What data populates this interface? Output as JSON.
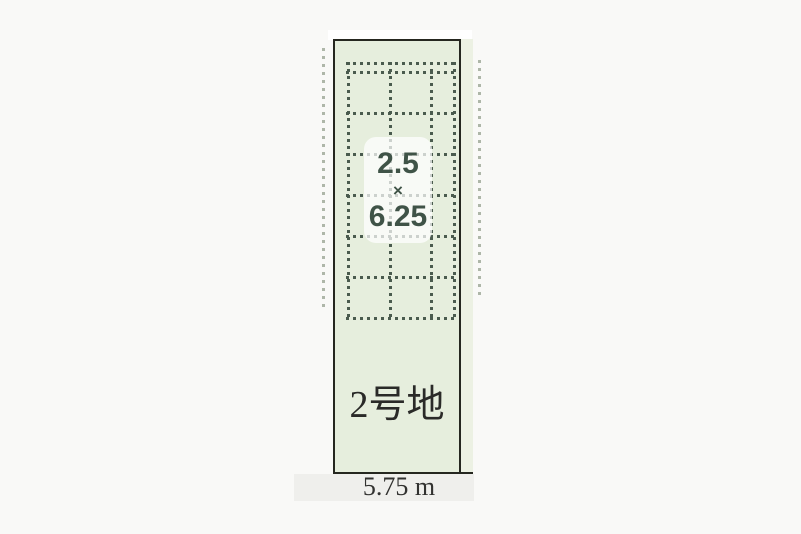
{
  "diagram": {
    "plot_name": "2号地",
    "size_label": {
      "width": "2.5",
      "times": "×",
      "depth": "6.25"
    },
    "frontage": "5.75 m"
  },
  "colors": {
    "page_bg": "#f9f9f7",
    "top_strip_bg": "#ffffff",
    "bottom_strip_bg": "#efefec",
    "plot_fill": "#e6eedd",
    "plot_fill_light": "#ecf1e3",
    "plot_border": "#25271f",
    "grid_dot": "#4a5b4e",
    "grid_dot_faded": "#9ba695",
    "size_text": "#3f5347",
    "name_text": "#2a2a28",
    "measure_text": "#323230",
    "size_box_bg": "rgba(255,255,255,0.72)"
  },
  "grid": {
    "interior_vertical": [
      {
        "x": 347,
        "y1": 62,
        "y2": 319
      },
      {
        "x": 389,
        "y1": 62,
        "y2": 319
      },
      {
        "x": 430,
        "y1": 62,
        "y2": 319
      },
      {
        "x": 453,
        "y1": 62,
        "y2": 319
      }
    ],
    "interior_horizontal": [
      {
        "y": 62,
        "x1": 346,
        "x2": 456
      },
      {
        "y": 71,
        "x1": 346,
        "x2": 456
      },
      {
        "y": 112,
        "x1": 346,
        "x2": 456
      },
      {
        "y": 153,
        "x1": 346,
        "x2": 456
      },
      {
        "y": 194,
        "x1": 346,
        "x2": 456
      },
      {
        "y": 235,
        "x1": 346,
        "x2": 456
      },
      {
        "y": 276,
        "x1": 346,
        "x2": 456
      },
      {
        "y": 317,
        "x1": 346,
        "x2": 457
      }
    ],
    "exterior_vertical": [
      {
        "x": 322,
        "y1": 48,
        "y2": 312
      },
      {
        "x": 478,
        "y1": 60,
        "y2": 300
      }
    ]
  }
}
